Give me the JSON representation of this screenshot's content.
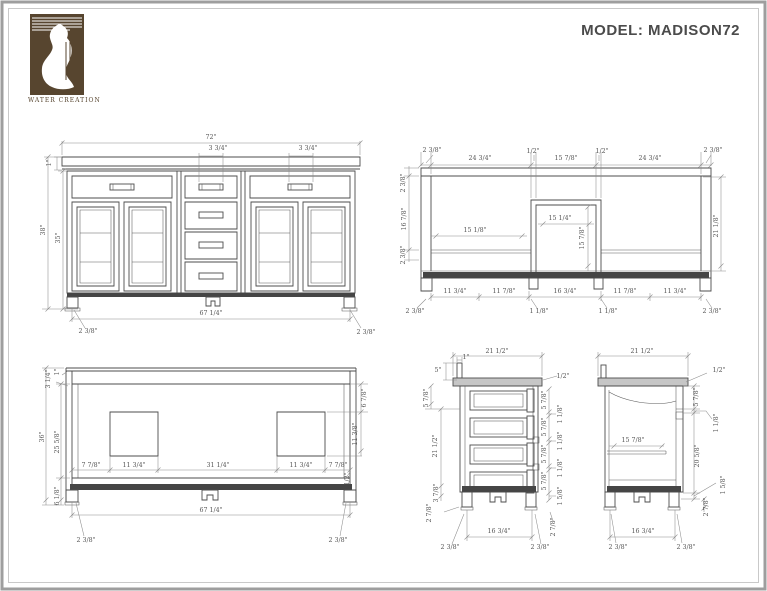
{
  "header": {
    "model_title": "MODEL: MADISON72",
    "brand": "WATER CREATION"
  },
  "colors": {
    "logo_brown": "#57452f",
    "line": "#4c4c4c",
    "dimension": "#555555",
    "title_text": "#4b4b4b",
    "dark_band": "#454545"
  },
  "views": [
    {
      "id": "front-elevation",
      "labels": [
        {
          "t": "72\"",
          "x": 211,
          "y": 138
        },
        {
          "t": "3 3/4\"",
          "x": 218,
          "y": 149
        },
        {
          "t": "3 3/4\"",
          "x": 308,
          "y": 149
        },
        {
          "t": "1\"",
          "x": 50,
          "y": 163,
          "r": 1
        },
        {
          "t": "38\"",
          "x": 44,
          "y": 230,
          "r": 1
        },
        {
          "t": "35\"",
          "x": 59,
          "y": 238,
          "r": 1
        },
        {
          "t": "67 1/4\"",
          "x": 211,
          "y": 314
        },
        {
          "t": "2 3/8\"",
          "x": 88,
          "y": 332
        },
        {
          "t": "2 3/8\"",
          "x": 366,
          "y": 333
        }
      ]
    },
    {
      "id": "open-front-section",
      "labels": [
        {
          "t": "2 3/8\"",
          "x": 432,
          "y": 151
        },
        {
          "t": "24 3/4\"",
          "x": 480,
          "y": 159
        },
        {
          "t": "1/2\"",
          "x": 533,
          "y": 152
        },
        {
          "t": "15 7/8\"",
          "x": 566,
          "y": 159
        },
        {
          "t": "1/2\"",
          "x": 602,
          "y": 152
        },
        {
          "t": "24 3/4\"",
          "x": 650,
          "y": 159
        },
        {
          "t": "2 3/8\"",
          "x": 713,
          "y": 151
        },
        {
          "t": "2 3/8\"",
          "x": 404,
          "y": 183,
          "r": 1
        },
        {
          "t": "16 7/8\"",
          "x": 405,
          "y": 219,
          "r": 1
        },
        {
          "t": "2 3/8\"",
          "x": 404,
          "y": 255,
          "r": 1
        },
        {
          "t": "15 1/8\"",
          "x": 475,
          "y": 231
        },
        {
          "t": "15 1/4\"",
          "x": 560,
          "y": 219
        },
        {
          "t": "15 7/8\"",
          "x": 583,
          "y": 238,
          "r": 1
        },
        {
          "t": "21 1/8\"",
          "x": 717,
          "y": 226,
          "r": 1
        },
        {
          "t": "11 3/4\"",
          "x": 455,
          "y": 292
        },
        {
          "t": "11 7/8\"",
          "x": 504,
          "y": 292
        },
        {
          "t": "16 3/4\"",
          "x": 565,
          "y": 292
        },
        {
          "t": "11 7/8\"",
          "x": 625,
          "y": 292
        },
        {
          "t": "11 3/4\"",
          "x": 675,
          "y": 292
        },
        {
          "t": "2 3/8\"",
          "x": 415,
          "y": 312
        },
        {
          "t": "1 1/8\"",
          "x": 539,
          "y": 312
        },
        {
          "t": "1 1/8\"",
          "x": 608,
          "y": 312
        },
        {
          "t": "2 3/8\"",
          "x": 712,
          "y": 312
        }
      ]
    },
    {
      "id": "rear-elevation",
      "labels": [
        {
          "t": "3 1/4\"",
          "x": 49,
          "y": 379,
          "r": 1
        },
        {
          "t": "1\"",
          "x": 58,
          "y": 372,
          "r": 1
        },
        {
          "t": "36\"",
          "x": 43,
          "y": 437,
          "r": 1
        },
        {
          "t": "25 5/8\"",
          "x": 58,
          "y": 442,
          "r": 1
        },
        {
          "t": "6 1/8\"",
          "x": 58,
          "y": 496,
          "r": 1
        },
        {
          "t": "7 7/8\"",
          "x": 91,
          "y": 466
        },
        {
          "t": "11 3/4\"",
          "x": 134,
          "y": 466
        },
        {
          "t": "31 1/4\"",
          "x": 218,
          "y": 466
        },
        {
          "t": "11 3/4\"",
          "x": 301,
          "y": 466
        },
        {
          "t": "7 7/8\"",
          "x": 338,
          "y": 466
        },
        {
          "t": "6 7/8\"",
          "x": 365,
          "y": 398,
          "r": 1
        },
        {
          "t": "11 3/8\"",
          "x": 356,
          "y": 434,
          "r": 1
        },
        {
          "t": "1/2\"",
          "x": 348,
          "y": 479,
          "r": 1
        },
        {
          "t": "67 1/4\"",
          "x": 211,
          "y": 511
        },
        {
          "t": "2 3/8\"",
          "x": 86,
          "y": 541
        },
        {
          "t": "2 3/8\"",
          "x": 338,
          "y": 541
        }
      ]
    },
    {
      "id": "side-section-drawers",
      "labels": [
        {
          "t": "21 1/2\"",
          "x": 497,
          "y": 352
        },
        {
          "t": "1\"",
          "x": 466,
          "y": 358
        },
        {
          "t": "5\"",
          "x": 438,
          "y": 371
        },
        {
          "t": "5 7/8\"",
          "x": 427,
          "y": 398,
          "r": 1
        },
        {
          "t": "21 1/2\"",
          "x": 436,
          "y": 446,
          "r": 1
        },
        {
          "t": "3 7/8\"",
          "x": 437,
          "y": 493,
          "r": 1
        },
        {
          "t": "2 7/8\"",
          "x": 430,
          "y": 513,
          "r": 1
        },
        {
          "t": "1/2\"",
          "x": 563,
          "y": 377
        },
        {
          "t": "5 7/8\"",
          "x": 545,
          "y": 400,
          "r": 1
        },
        {
          "t": "1 1/8\"",
          "x": 561,
          "y": 414,
          "r": 1
        },
        {
          "t": "5 7/8\"",
          "x": 545,
          "y": 427,
          "r": 1
        },
        {
          "t": "1 1/8\"",
          "x": 561,
          "y": 441,
          "r": 1
        },
        {
          "t": "5 7/8\"",
          "x": 545,
          "y": 454,
          "r": 1
        },
        {
          "t": "1 1/8\"",
          "x": 561,
          "y": 468,
          "r": 1
        },
        {
          "t": "5 7/8\"",
          "x": 545,
          "y": 481,
          "r": 1
        },
        {
          "t": "1 5/8\"",
          "x": 561,
          "y": 496,
          "r": 1
        },
        {
          "t": "2 7/8\"",
          "x": 554,
          "y": 527,
          "r": 1
        },
        {
          "t": "16 3/4\"",
          "x": 499,
          "y": 532
        },
        {
          "t": "2 3/8\"",
          "x": 450,
          "y": 548
        },
        {
          "t": "2 3/8\"",
          "x": 540,
          "y": 548
        }
      ]
    },
    {
      "id": "side-section-open",
      "labels": [
        {
          "t": "21 1/2\"",
          "x": 642,
          "y": 352
        },
        {
          "t": "1/2\"",
          "x": 719,
          "y": 371
        },
        {
          "t": "5 7/8\"",
          "x": 697,
          "y": 397,
          "r": 1
        },
        {
          "t": "1 1/8\"",
          "x": 717,
          "y": 423,
          "r": 1
        },
        {
          "t": "15 7/8\"",
          "x": 633,
          "y": 441
        },
        {
          "t": "20 5/8\"",
          "x": 698,
          "y": 456,
          "r": 1
        },
        {
          "t": "1 5/8\"",
          "x": 724,
          "y": 485,
          "r": 1
        },
        {
          "t": "2 7/8\"",
          "x": 707,
          "y": 507,
          "r": 1
        },
        {
          "t": "16 3/4\"",
          "x": 643,
          "y": 532
        },
        {
          "t": "2 3/8\"",
          "x": 618,
          "y": 548
        },
        {
          "t": "2 3/8\"",
          "x": 686,
          "y": 548
        }
      ]
    }
  ]
}
